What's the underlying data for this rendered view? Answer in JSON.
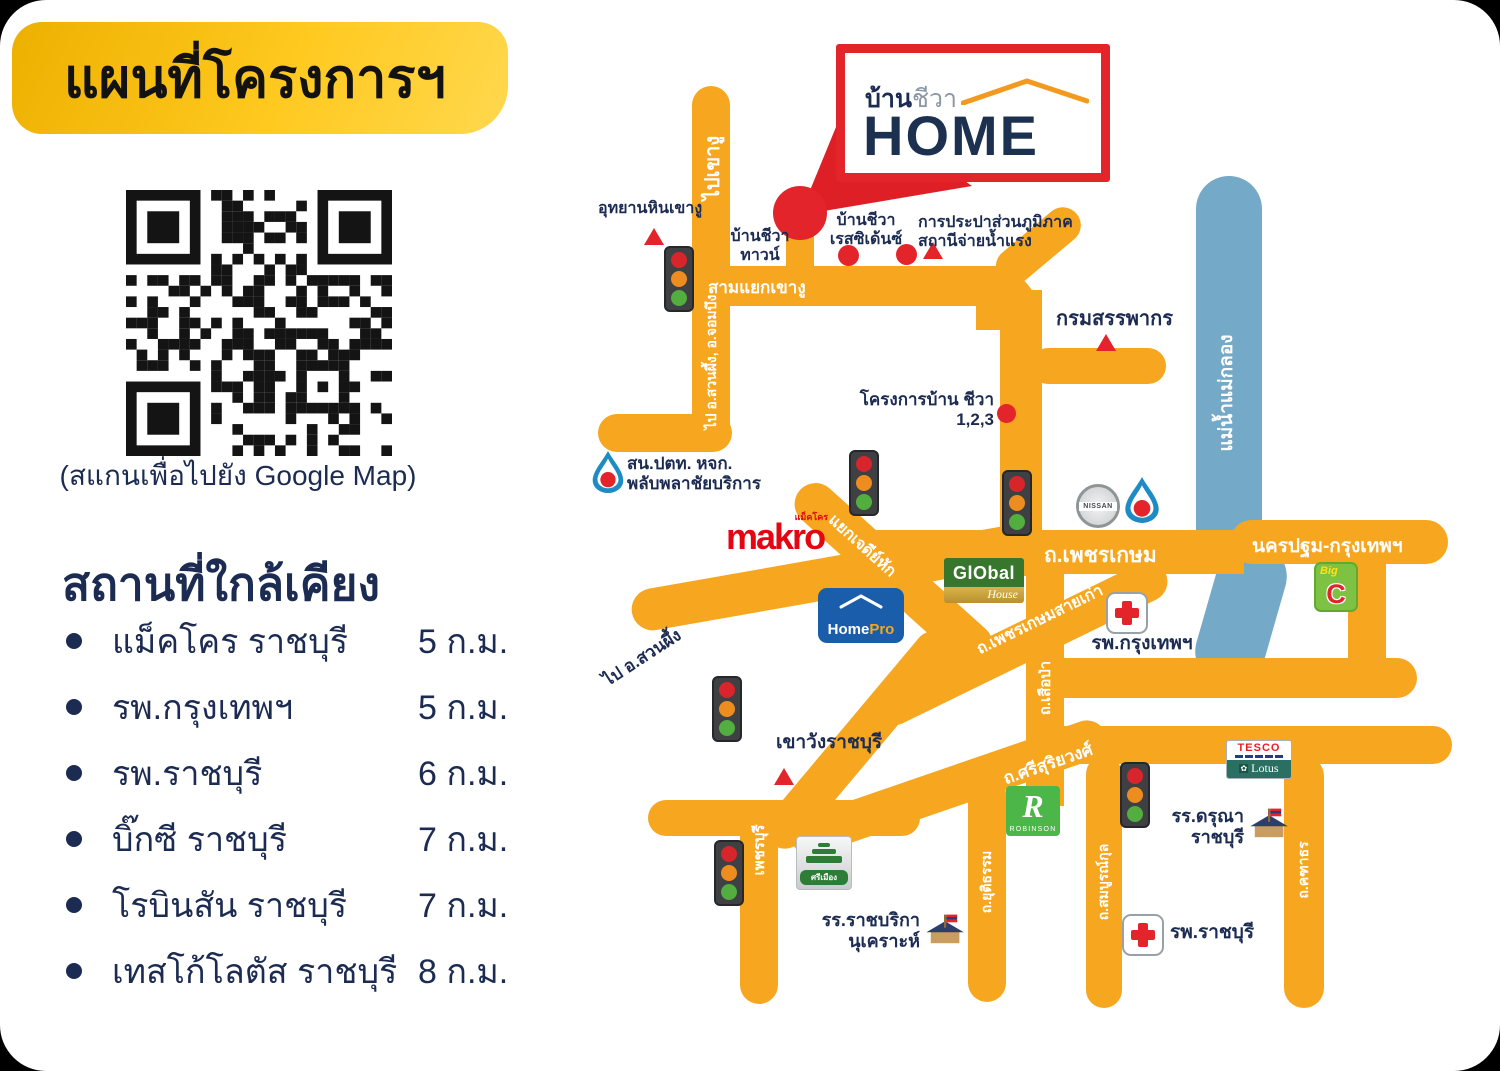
{
  "colors": {
    "road": "#F7A71F",
    "river": "#74A9C8",
    "navy": "#1C2B52",
    "red": "#E3242B",
    "banner_gold": "#FFC91F"
  },
  "banner": {
    "title": "แผนที่โครงการฯ"
  },
  "qr": {
    "caption": "(สแกนเพื่อไปยัง Google Map)"
  },
  "nearby": {
    "heading": "สถานที่ใกล้เคียง",
    "items": [
      {
        "name": "แม็คโคร ราชบุรี",
        "distance": "5 ก.ม."
      },
      {
        "name": "รพ.กรุงเทพฯ",
        "distance": "5 ก.ม."
      },
      {
        "name": "รพ.ราชบุรี",
        "distance": "6 ก.ม."
      },
      {
        "name": "บิ๊กซี ราชบุรี",
        "distance": "7 ก.ม."
      },
      {
        "name": "โรบินสัน ราชบุรี",
        "distance": "7 ก.ม."
      },
      {
        "name": "เทสโก้โลตัส ราชบุรี",
        "distance": "8 ก.ม."
      }
    ]
  },
  "logo": {
    "thai_bold": "บ้าน",
    "thai_light": "ชีวา",
    "home": "HOME"
  },
  "map": {
    "labels": {
      "uthayan": "อุทยานหินเขางู",
      "pai_khao_ngu": "ไปเขางู",
      "samyak": "สามแยกเขางู",
      "town": "บ้านชีวา\nทาวน์",
      "residence": "บ้านชีวา\nเรสซิเด้นซ์",
      "prapa": "การประปาส่วนภูมิภาค\nสถานีจ่ายน้ำแรง",
      "revenue": "กรมสรรพากร",
      "suanphueng_jombueng": "ไป อ.สวนผึ้ง, อ.จอมบึง",
      "project123": "โครงการบ้าน ชีวา\n1,2,3",
      "ptt_station": "สน.ปตท. หจก.\nพลับพลาชัยบริการ",
      "phetkasem": "ถ.เพชรเกษม",
      "nakhon_pathom_bkk": "นครปฐม-กรุงเทพฯ",
      "river": "แม่น้ำแม่กลอง",
      "jedi_hak": "แยกเจดีย์หัก",
      "pai_suanphueng": "ไป อ.สวนผึ้ง",
      "phetkasem_old": "ถ.เพชรเกษมสายเก่า",
      "bkk_hospital": "รพ.กรุงเทพฯ",
      "sueapa": "ถ.เสือป่า",
      "khao_wang": "เขาวังราชบุรี",
      "srisuriyawong": "ถ.ศรีสุริยวงศ์",
      "phetchaburi": "เพชรบุรี",
      "yutitham": "ถ.ยุติธรรม",
      "sombunkul": "ถ.สมบูรณ์กุล",
      "kathathorn": "ถ.คฑาธร",
      "daruna": "รร.ดรุณา\nราชบุรี",
      "ratchaburi_hospital": "รพ.ราชบุรี",
      "ratburika": "รร.ราชบริกา\nนุเคราะห์"
    },
    "logos": {
      "makro": "makro",
      "makro_sub": "แม็คโคร",
      "homepro_home": "Home",
      "homepro_pro": "Pro",
      "global_top": "GlObal",
      "global_bottom": "House",
      "nissan": "NISSAN",
      "bigc_big": "Big",
      "bigc_c": "C",
      "tesco": "TESCO",
      "lotus": "Lotus",
      "robinson_r": "R",
      "robinson": "ROBINSON",
      "srimueang": "ศรีเมือง"
    }
  }
}
